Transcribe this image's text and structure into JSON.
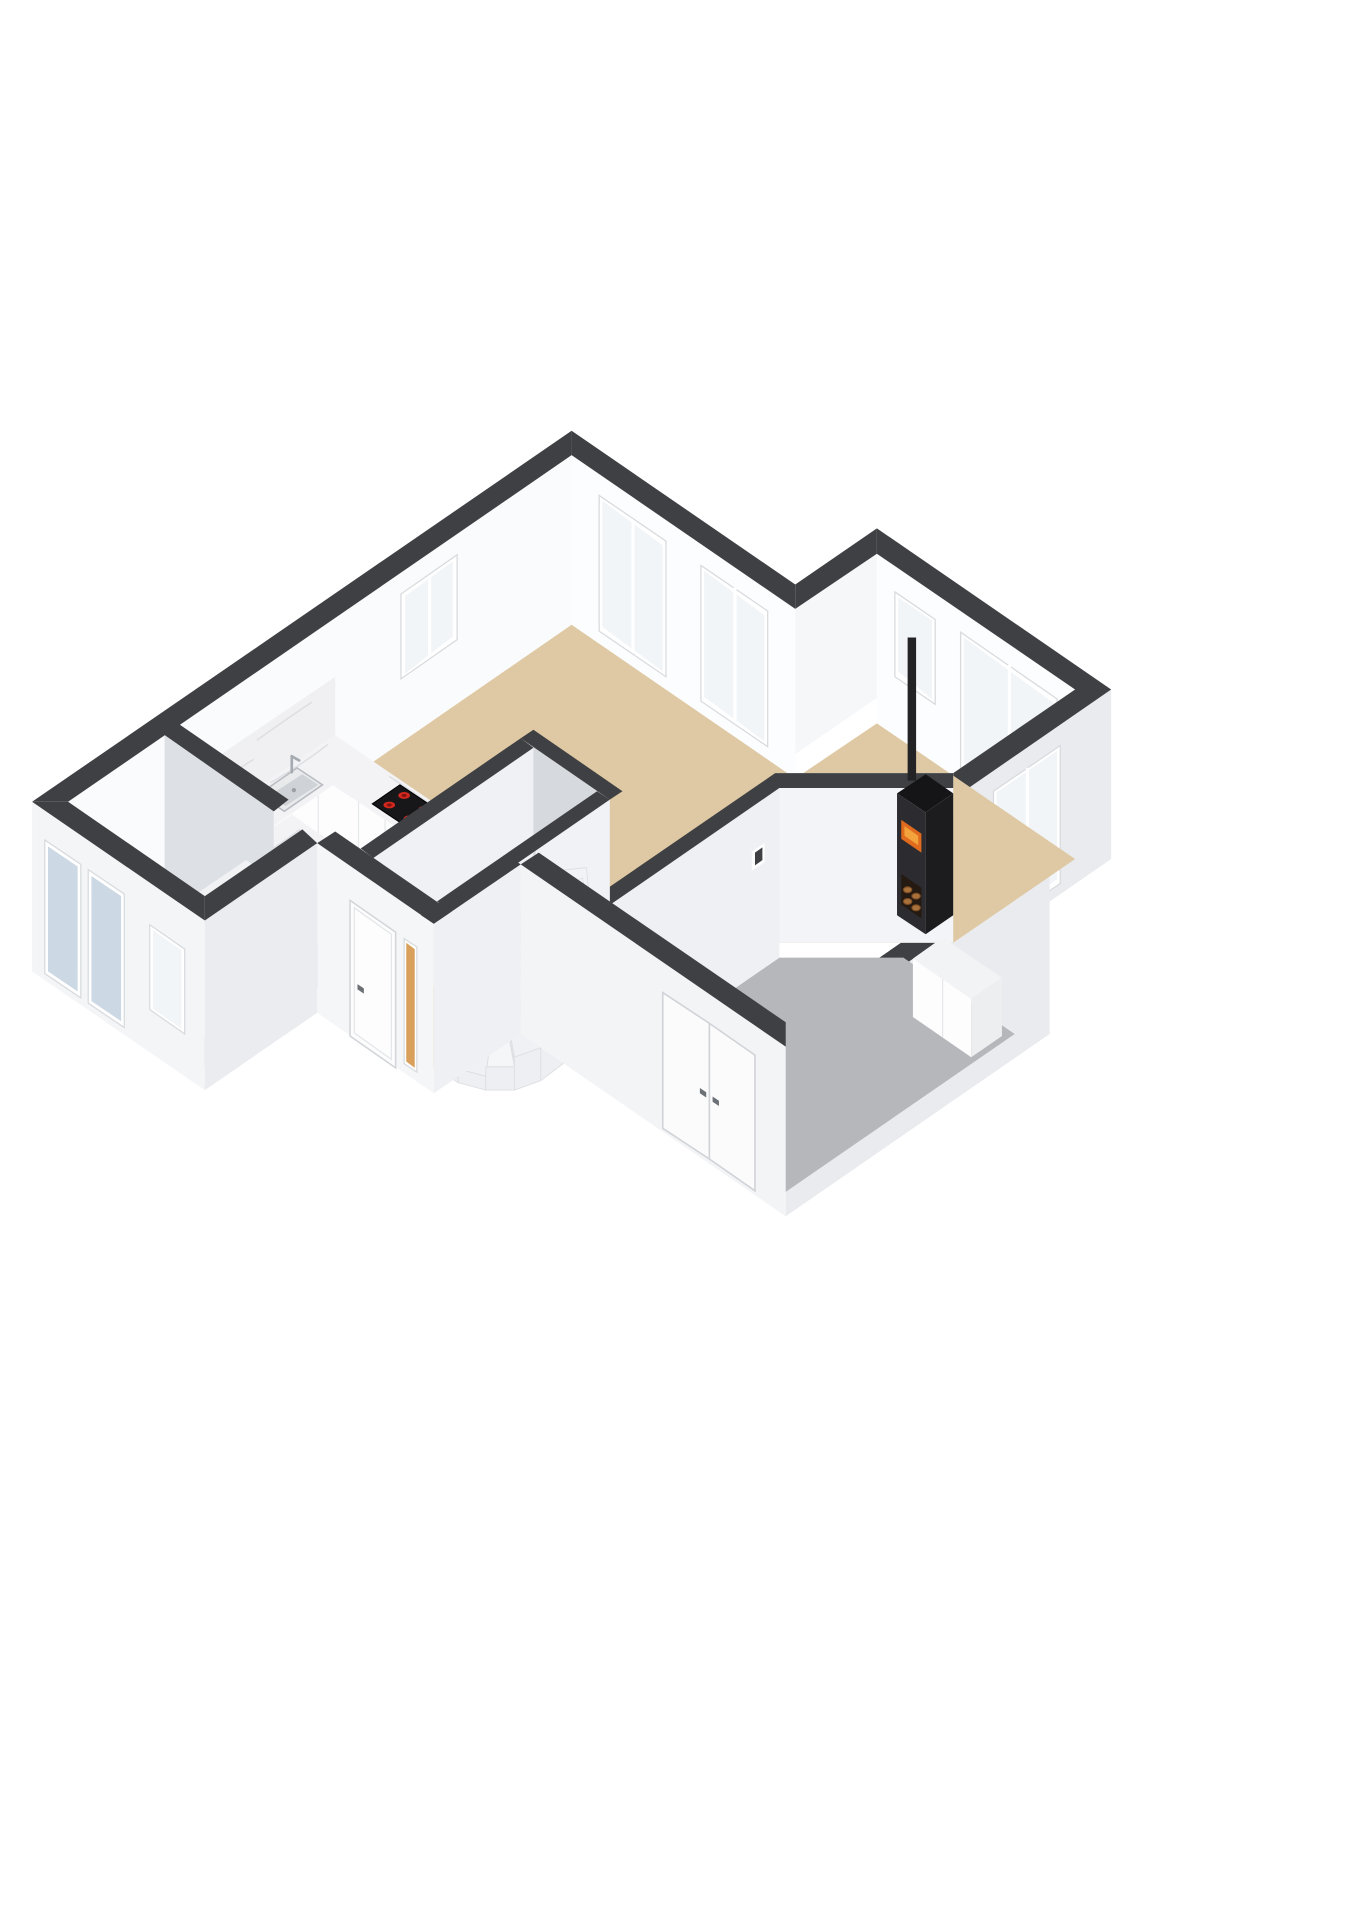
{
  "scene": {
    "kind": "3d-floor-plan-render",
    "view": "isometric-from-south",
    "background": "#ffffff",
    "has_text": false
  },
  "colors": {
    "background": "#ffffff",
    "wall_top": "#3e4043",
    "wall_white": "#fafbfd",
    "wall_bright": "#fcfdfe",
    "wall_light": "#f3f4f7",
    "wall_shade": "#d6d9dd",
    "wall_midshade": "#dde0e4",
    "wall_ext": "#e9ebee",
    "wall_ext_bright": "#f4f5f7",
    "floor_living": "#dfc9a4",
    "floor_hall": "#e1aa64",
    "floor_kitchen": "#b9c4d3",
    "floor_utility": "#bcc7d5",
    "floor_garage": "#b6b7bb",
    "marble": "#f3f3f6",
    "marble_vein": "#d9dade",
    "cabinet_front": "#fdfdfe",
    "cabinet_side": "#f0f1f3",
    "glazing": "#f2f5f8",
    "glazing_blue": "#ccd9e4",
    "sidelight_orange": "#d9a05b",
    "window_frame": "#ffffff",
    "frame_stroke": "#d8dbde",
    "door_white": "#fbfbfc",
    "handle_gray": "#6b7075",
    "stove_black": "#2c2c30",
    "stove_dark": "#1c1c1f",
    "stove_top": "#151518",
    "fire_orange": "#e06a1e",
    "fire_glow": "#f3a33c",
    "log_brown": "#a8713c",
    "log_dark": "#241a12",
    "steel": "#cfd3d7",
    "steel_rim": "#e8eaec",
    "burner_red": "#d0281f",
    "burner_core": "#7e120d",
    "stair_tread": "#f5f6f8",
    "stair_riser": "#e2e4e8",
    "stair_side": "#edeff2",
    "tick_gray": "#9aa0a5"
  },
  "rooms": [
    {
      "id": "living-dining",
      "label": "Living / dining room",
      "floor": "beige",
      "features": [
        "wood-stove",
        "dining-nook"
      ]
    },
    {
      "id": "kitchen",
      "label": "Open kitchen",
      "floor": "blue-gray",
      "features": [
        "l-shaped-counter",
        "sink",
        "faucet",
        "induction-cooktop",
        "island",
        "marble-backsplash"
      ]
    },
    {
      "id": "utility",
      "label": "Utility room",
      "floor": "blue-gray",
      "features": [
        "tall-cabinets"
      ]
    },
    {
      "id": "hallway",
      "label": "Hallway / entry",
      "floor": "orange",
      "features": [
        "winder-staircase",
        "front-door",
        "orange-sidelight"
      ]
    },
    {
      "id": "garage",
      "label": "Garage / storage",
      "floor": "concrete-gray",
      "features": [
        "double-doors",
        "low-cabinet",
        "wall-hatch"
      ]
    }
  ],
  "fixtures": {
    "stove": {
      "body": "black",
      "fire_visible": true,
      "log_storage": true,
      "chimney": true
    },
    "cooktop": {
      "burners": 4,
      "burner_color": "red"
    },
    "sink": {
      "material": "stainless",
      "faucet": true
    },
    "staircase": {
      "type": "winder",
      "treads": 9,
      "landing": true
    },
    "island": {
      "top": "marble"
    },
    "counters": {
      "top": "marble",
      "backsplash": "marble"
    }
  },
  "openings": {
    "windows": [
      "west-wall-upper",
      "kitchen-sink-window",
      "north-slider-left",
      "north-slider-right",
      "nook-small",
      "nook-wide",
      "nook-tall-east",
      "utility-window"
    ],
    "exterior_doors": [
      "front-door",
      "garage-double-door",
      "patio-door-left",
      "patio-door-right"
    ],
    "door_swing_marks": 3
  }
}
